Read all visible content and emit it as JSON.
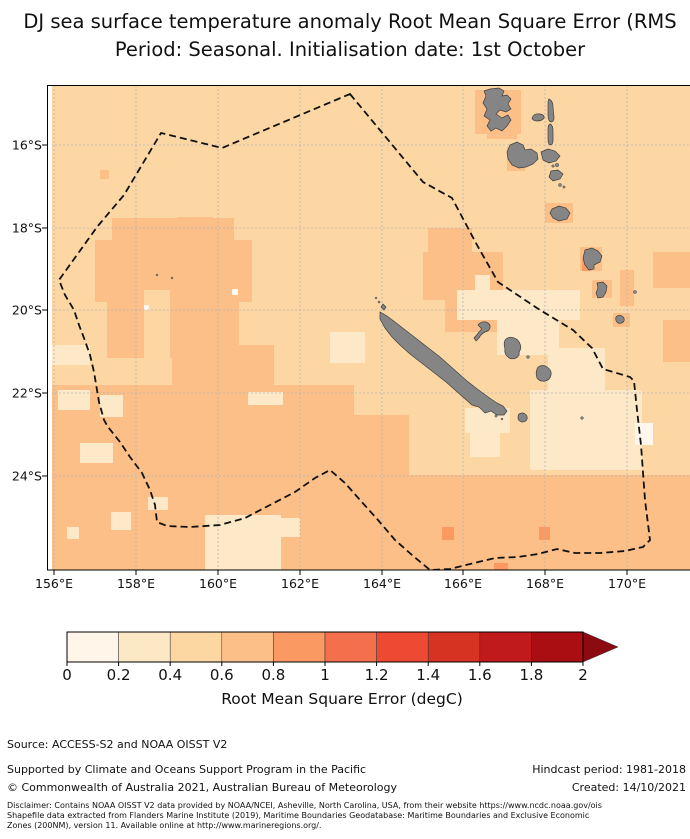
{
  "title": {
    "line1": "DJ sea surface temperature anomaly Root Mean Square Error (RMS",
    "line2": "Period: Seasonal. Initialisation date: 1st October"
  },
  "axes": {
    "lon_ticks": [
      {
        "label": "156°E",
        "x": 54
      },
      {
        "label": "158°E",
        "x": 136
      },
      {
        "label": "160°E",
        "x": 218
      },
      {
        "label": "162°E",
        "x": 300
      },
      {
        "label": "164°E",
        "x": 382
      },
      {
        "label": "166°E",
        "x": 463
      },
      {
        "label": "168°E",
        "x": 545
      },
      {
        "label": "170°E",
        "x": 627
      }
    ],
    "lat_ticks": [
      {
        "label": "16°S",
        "y": 145
      },
      {
        "label": "18°S",
        "y": 228
      },
      {
        "label": "20°S",
        "y": 310
      },
      {
        "label": "22°S",
        "y": 393
      },
      {
        "label": "24°S",
        "y": 476
      }
    ]
  },
  "map_colors": {
    "base": "#fcd7a4",
    "bin1": "#fff7ec",
    "bin2": "#fde9c8",
    "bin4": "#fbbf87",
    "bin5": "#fa9a62",
    "island_fill": "#858585",
    "island_stroke": "#3e3e3e",
    "grid": "#b5b5b5",
    "boundary": "#111111"
  },
  "map_geometry": {
    "eez": [
      [
        303,
        9
      ],
      [
        376,
        97
      ],
      [
        405,
        113
      ],
      [
        430,
        160
      ],
      [
        451,
        197
      ],
      [
        493,
        225
      ],
      [
        526,
        245
      ],
      [
        545,
        263
      ],
      [
        556,
        284
      ],
      [
        583,
        292
      ],
      [
        587,
        296
      ],
      [
        590,
        325
      ],
      [
        594,
        360
      ],
      [
        598,
        415
      ],
      [
        603,
        455
      ],
      [
        596,
        462
      ],
      [
        578,
        466
      ],
      [
        553,
        468
      ],
      [
        528,
        468
      ],
      [
        510,
        464
      ],
      [
        491,
        469
      ],
      [
        471,
        472
      ],
      [
        448,
        473
      ],
      [
        423,
        479
      ],
      [
        403,
        484
      ],
      [
        383,
        485
      ],
      [
        365,
        470
      ],
      [
        348,
        455
      ],
      [
        331,
        435
      ],
      [
        313,
        415
      ],
      [
        298,
        398
      ],
      [
        283,
        385
      ],
      [
        268,
        393
      ],
      [
        248,
        407
      ],
      [
        223,
        420
      ],
      [
        198,
        433
      ],
      [
        173,
        440
      ],
      [
        143,
        442
      ],
      [
        120,
        441
      ],
      [
        110,
        437
      ],
      [
        108,
        420
      ],
      [
        103,
        405
      ],
      [
        95,
        388
      ],
      [
        83,
        372
      ],
      [
        73,
        357
      ],
      [
        61,
        342
      ],
      [
        57,
        335
      ],
      [
        52,
        317
      ],
      [
        47,
        287
      ],
      [
        43,
        270
      ],
      [
        37,
        253
      ],
      [
        32,
        240
      ],
      [
        27,
        225
      ],
      [
        18,
        210
      ],
      [
        12,
        195
      ],
      [
        50,
        142
      ],
      [
        77,
        110
      ],
      [
        114,
        48
      ],
      [
        175,
        63
      ]
    ],
    "patches": {
      "bin4": [
        [
          53,
          85,
          9,
          9
        ],
        [
          65,
          133,
          122,
          26
        ],
        [
          130,
          132,
          36,
          14
        ],
        [
          48,
          155,
          157,
          62
        ],
        [
          60,
          215,
          132,
          58
        ],
        [
          125,
          260,
          102,
          68
        ],
        [
          0,
          300,
          307,
          185
        ],
        [
          220,
          330,
          142,
          155
        ],
        [
          305,
          390,
          343,
          95
        ],
        [
          381,
          143,
          44,
          25
        ],
        [
          376,
          167,
          80,
          48
        ],
        [
          398,
          215,
          58,
          32
        ],
        [
          428,
          5,
          46,
          44
        ],
        [
          440,
          45,
          30,
          9
        ],
        [
          460,
          62,
          18,
          24
        ],
        [
          498,
          118,
          28,
          20
        ],
        [
          533,
          162,
          22,
          24
        ],
        [
          545,
          195,
          20,
          18
        ],
        [
          566,
          228,
          17,
          14
        ],
        [
          606,
          167,
          37,
          36
        ],
        [
          616,
          235,
          27,
          42
        ],
        [
          573,
          185,
          14,
          36
        ]
      ],
      "base": [
        [
          97,
          205,
          26,
          75
        ]
      ],
      "bin2": [
        [
          410,
          205,
          123,
          30
        ],
        [
          450,
          228,
          62,
          42
        ],
        [
          483,
          305,
          112,
          80
        ],
        [
          501,
          263,
          57,
          44
        ],
        [
          418,
          323,
          45,
          25
        ],
        [
          423,
          348,
          30,
          24
        ],
        [
          283,
          247,
          35,
          31
        ],
        [
          158,
          430,
          76,
          56
        ],
        [
          215,
          433,
          38,
          19
        ],
        [
          64,
          427,
          20,
          18
        ],
        [
          20,
          442,
          12,
          12
        ],
        [
          33,
          358,
          33,
          20
        ],
        [
          53,
          310,
          23,
          22
        ],
        [
          101,
          412,
          20,
          13
        ],
        [
          0,
          260,
          43,
          20
        ],
        [
          11,
          305,
          32,
          20
        ],
        [
          201,
          307,
          35,
          13
        ],
        [
          428,
          190,
          15,
          15
        ]
      ],
      "bin1": [
        [
          588,
          338,
          18,
          22
        ],
        [
          185,
          204,
          6,
          6
        ],
        [
          97,
          220,
          5,
          5
        ]
      ],
      "bin5": [
        [
          535,
          174,
          9,
          12
        ],
        [
          395,
          442,
          12,
          13
        ],
        [
          492,
          442,
          11,
          13
        ],
        [
          447,
          478,
          14,
          8
        ]
      ]
    },
    "islands": [
      {
        "name": "grande-terre",
        "path": "M333,227 L340,231 348,237 357,244 366,251 375,258 384,265 393,272 402,280 411,288 420,296 429,303 437,309 444,314 450,318 456,321 460,326 457,330 450,330 444,326 438,328 432,322 425,320 417,313 408,305 399,297 390,290 381,283 372,276 363,269 354,261 345,252 338,243 333,234 Z"
      },
      {
        "name": "espiritu-santo",
        "path": "M443,4 L452,3 457,6 455,11 460,10 464,14 461,19 464,24 459,27 453,25 449,29 455,33 461,30 464,35 460,41 455,46 449,43 444,46 440,41 443,35 437,31 440,24 436,18 439,11 437,6 Z"
      },
      {
        "name": "malakula",
        "path": "M463,60 L470,57 476,60 478,65 484,64 490,68 491,74 486,79 479,82 472,83 465,80 461,74 460,67 Z"
      },
      {
        "name": "ambrym",
        "path": "M494,67 L501,64 508,66 513,71 509,76 502,78 496,75 Z"
      },
      {
        "name": "epi",
        "path": "M504,86 L511,85 516,89 513,94 506,96 502,92 Z"
      },
      {
        "name": "efate",
        "path": "M505,124 L512,121 519,123 523,128 520,134 512,136 506,133 503,128 Z"
      },
      {
        "name": "erromango",
        "path": "M538,165 L545,163 551,166 555,171 553,177 547,180 547,184 542,185 538,180 536,173 Z"
      },
      {
        "name": "tanna",
        "path": "M550,198 L556,197 560,201 559,207 556,212 551,213 549,208 551,203 Z"
      },
      {
        "name": "aoba",
        "path": "M485,33 Q487,28 493,29 Q498,30 497,33 Q495,36 490,36 Q486,36 485,33 Z"
      },
      {
        "name": "maewo",
        "path": "M502,14 Q506,16 506,22 L507,32 Q507,37 504,37 Q501,36 501,30 L501,19 Q501,15 502,14 Z"
      },
      {
        "name": "pentecost",
        "path": "M503,39 Q506,40 506,46 L506,55 Q506,60 503,60 Q501,59 501,54 L501,44 Q501,40 503,39 Z"
      },
      {
        "name": "ouvea",
        "path": "M431,240 Q434,236 439,237 Q444,239 443,243 Q442,246 438,247 Q434,249 432,253 L429,256 427,253 Q430,250 432,247 Q435,245 434,243 Q432,241 431,240 Z"
      },
      {
        "name": "lifou",
        "path": "M459,254 Q463,251 467,253 Q472,255 473,259 Q475,263 472,267 Q473,271 469,273 Q464,275 461,272 Q457,269 458,264 Q456,257 459,254 Z"
      },
      {
        "name": "mare",
        "path": "M491,282 Q496,279 500,282 Q505,285 504,290 Q503,295 498,296 Q493,297 490,293 Q488,287 491,282 Z"
      },
      {
        "name": "ile-des-pins",
        "path": "M472,329 Q476,327 478,329 Q481,331 480,334 Q479,337 475,337 Q471,336 471,333 Q471,330 472,329 Z"
      },
      {
        "name": "aneityum",
        "path": "M569,232 Q572,229 575,231 Q578,233 577,236 Q575,239 571,238 Q568,236 569,232 Z"
      },
      {
        "name": "belep",
        "path": "M336,219 L339,222 337,225 334,222 Z"
      }
    ],
    "island_dots": [
      {
        "name": "belep-islet",
        "cx": 329,
        "cy": 213,
        "r": 1
      },
      {
        "name": "belep-islet",
        "cx": 332,
        "cy": 217,
        "r": 1.1
      },
      {
        "name": "reef-islet",
        "cx": 110,
        "cy": 190,
        "r": 1
      },
      {
        "name": "reef-islet",
        "cx": 125,
        "cy": 193,
        "r": 1
      },
      {
        "name": "islet-south-lagoon",
        "cx": 449,
        "cy": 331,
        "r": 1.2
      },
      {
        "name": "islet-south-lagoon",
        "cx": 455,
        "cy": 334,
        "r": 1
      },
      {
        "name": "tiga",
        "cx": 481,
        "cy": 272,
        "r": 1.5
      },
      {
        "name": "walpole",
        "cx": 535,
        "cy": 333,
        "r": 1.4
      },
      {
        "name": "futuna",
        "cx": 588,
        "cy": 207,
        "r": 1.6
      },
      {
        "name": "lopevi",
        "cx": 510,
        "cy": 80,
        "r": 1.8
      },
      {
        "name": "paama",
        "cx": 506,
        "cy": 81,
        "r": 1.3
      },
      {
        "name": "tongoa",
        "cx": 513,
        "cy": 100,
        "r": 1.6
      },
      {
        "name": "tongariki",
        "cx": 517,
        "cy": 102,
        "r": 1.2
      }
    ]
  },
  "colorbar": {
    "tick_labels": [
      "0",
      "0.2",
      "0.4",
      "0.6",
      "0.8",
      "1",
      "1.2",
      "1.4",
      "1.6",
      "1.8",
      "2"
    ],
    "segment_colors": [
      "#fff6e9",
      "#fde8c6",
      "#fcd7a2",
      "#fbbf87",
      "#fa9a62",
      "#f46f4b",
      "#ee4a33",
      "#d63323",
      "#c01a1c",
      "#aa0e13"
    ],
    "arrow_color": "#8c0b10",
    "label": "Root Mean Square Error (degC)"
  },
  "footer": {
    "source": "Source: ACCESS-S2 and NOAA OISST V2",
    "supported": "Supported by Climate and Oceans Support Program in the Pacific",
    "hindcast": "Hindcast period: 1981-2018",
    "copyright": "© Commonwealth of Australia 2021, Australian Bureau of Meteorology",
    "created": "Created: 14/10/2021",
    "disclaimer_line1": "Disclaimer: Contains NOAA OISST V2 data provided by NOAA/NCEI, Asheville, North Carolina, USA, from their website https://www.ncdc.noaa.gov/ois",
    "disclaimer_line2": "Shapefile data extracted from Flanders Marine Institute (2019), Maritime Boundaries Geodatabase: Maritime Boundaries and Exclusive Economic",
    "disclaimer_line3": "Zones (200NM), version 11. Available online at http://www.marineregions.org/."
  }
}
